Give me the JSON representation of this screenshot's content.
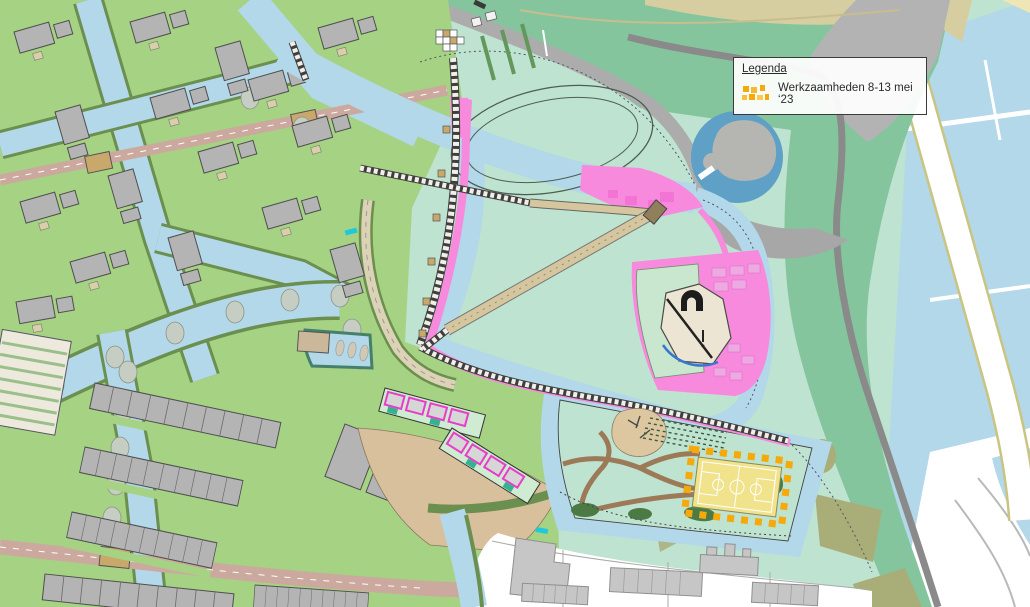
{
  "legend": {
    "title": "Legenda",
    "items": [
      {
        "icon": "works-hatch-icon",
        "label": "Werkzaamheden 8-13 mei ‘23"
      }
    ]
  },
  "palette": {
    "mint": "#BEE3D0",
    "bandGreen": "#85C59E",
    "yard": "#A6D284",
    "water": "#B2D8E9",
    "pond": "#5EA0C6",
    "island": "#B5B5B2",
    "pink": "#F78ADC",
    "pinkDeep": "#EF63CE",
    "tan": "#D5C69E",
    "sand": "#DCC7A0",
    "plaza": "#D9C09D",
    "mauve": "#CCA99E",
    "roadGray": "#ACACAC",
    "darkGray": "#8A8A8A",
    "olive": "#A9AE79",
    "oliveDark": "#6B8F4E",
    "house": "#B4B4B4",
    "cream": "#EDE5D4",
    "khaki": "#D6CEA0",
    "bush": "#4C7A45",
    "brown": "#9C7A58",
    "court": "#F1E28C",
    "works": "#F6A90B"
  }
}
